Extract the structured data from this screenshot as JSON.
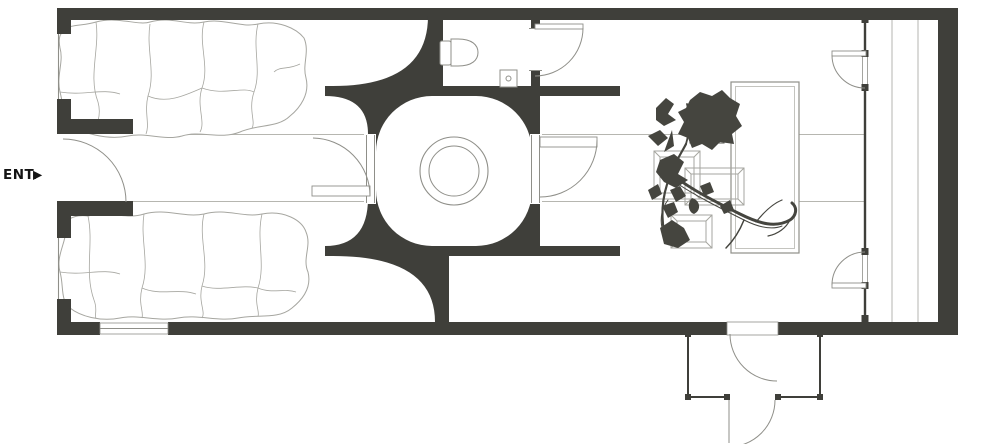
{
  "entrance": {
    "label": "ENT.",
    "arrow": "▶"
  },
  "colors": {
    "wall": "#3f3f3a",
    "line_light": "#a6a6a0",
    "line_mid": "#8f8f89",
    "corridor_line": "#b6b6b0",
    "plant": "#45453f",
    "background": "#ffffff"
  }
}
